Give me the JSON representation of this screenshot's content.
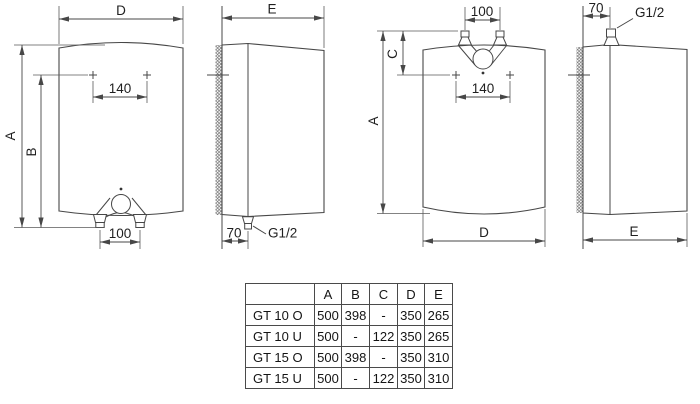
{
  "colors": {
    "line": "#474747",
    "text": "#1f1f1f",
    "background": "#ffffff"
  },
  "views": {
    "over_sink_front": {
      "width": "D",
      "height": "A",
      "mount_height": "B",
      "mount_spacing": "140",
      "pipe_spacing": "100"
    },
    "over_sink_side": {
      "depth": "E",
      "wall_offset": "70",
      "thread": "G1/2"
    },
    "under_sink_front": {
      "width": "D",
      "height": "A",
      "top_offset": "C",
      "mount_spacing": "140",
      "pipe_spacing": "100"
    },
    "under_sink_side": {
      "depth": "E",
      "wall_offset": "70",
      "thread": "G1/2"
    }
  },
  "table": {
    "headers": [
      "",
      "A",
      "B",
      "C",
      "D",
      "E"
    ],
    "rows": [
      [
        "GT 10 O",
        "500",
        "398",
        "-",
        "350",
        "265"
      ],
      [
        "GT 10 U",
        "500",
        "-",
        "122",
        "350",
        "265"
      ],
      [
        "GT 15 O",
        "500",
        "398",
        "-",
        "350",
        "310"
      ],
      [
        "GT 15 U",
        "500",
        "-",
        "122",
        "350",
        "310"
      ]
    ]
  }
}
